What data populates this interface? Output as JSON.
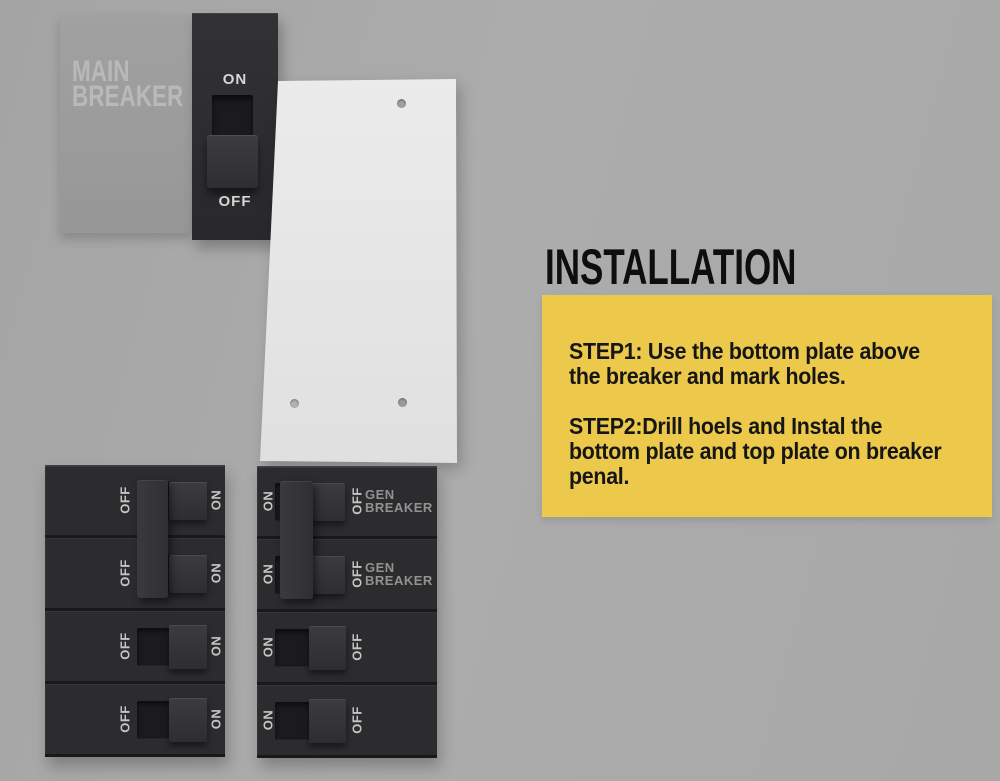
{
  "colors": {
    "background": "#a9a9a9",
    "breaker_dark": "#2c2b2d",
    "panel_gray": "#9c9c9c",
    "plate_white": "#e7e7e7",
    "accent_yellow": "#edc94b",
    "title_black": "#0e0e0e",
    "label_light": "#c6c6c6"
  },
  "main_breaker": {
    "label": "MAIN\nBREAKER",
    "on_label": "ON",
    "off_label": "OFF"
  },
  "plate": {
    "hole_count": 3
  },
  "left_panel": {
    "rows": [
      {
        "left_label": "OFF",
        "right_label": "ON"
      },
      {
        "left_label": "OFF",
        "right_label": "ON"
      },
      {
        "left_label": "OFF",
        "right_label": "ON"
      },
      {
        "left_label": "OFF",
        "right_label": "ON"
      }
    ]
  },
  "right_panel": {
    "rows": [
      {
        "left_label": "ON",
        "right_label": "OFF",
        "tag": "GEN\nBREAKER"
      },
      {
        "left_label": "ON",
        "right_label": "OFF",
        "tag": "GEN\nBREAKER"
      },
      {
        "left_label": "ON",
        "right_label": "OFF"
      },
      {
        "left_label": "ON",
        "right_label": "OFF"
      }
    ]
  },
  "installation": {
    "title": "INSTALLATION",
    "step1": "STEP1: Use the bottom plate above\nthe breaker and mark holes.",
    "step2": "STEP2:Drill hoels and Instal the\nbottom plate and top plate on breaker\npenal."
  }
}
